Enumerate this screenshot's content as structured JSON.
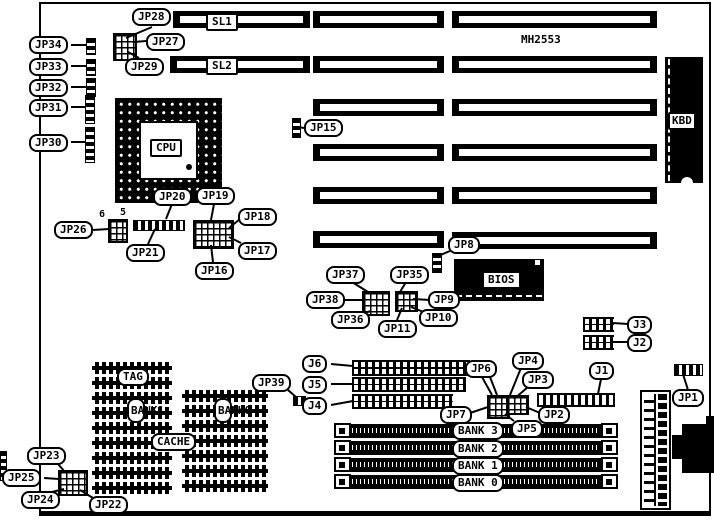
{
  "diagram": {
    "type": "motherboard jumper/connector location diagram",
    "board_model": "MH2553"
  },
  "callouts": {
    "jp28": "JP28",
    "jp27": "JP27",
    "jp29": "JP29",
    "sl1": "SL1",
    "sl2": "SL2",
    "jp34": "JP34",
    "jp33": "JP33",
    "jp32": "JP32",
    "jp31": "JP31",
    "jp30": "JP30",
    "jp15": "JP15",
    "kbd": "KBD",
    "cpu": "CPU",
    "jp20": "JP20",
    "jp19": "JP19",
    "jp18": "JP18",
    "jp17": "JP17",
    "jp16": "JP16",
    "jp26": "JP26",
    "jp21": "JP21",
    "jp8": "JP8",
    "bios": "BIOS",
    "jp37": "JP37",
    "jp35": "JP35",
    "jp38": "JP38",
    "jp9": "JP9",
    "jp36": "JP36",
    "jp11": "JP11",
    "jp10": "JP10",
    "j3": "J3",
    "j2": "J2",
    "j1": "J1",
    "jp1": "JP1",
    "j6": "J6",
    "j5": "J5",
    "j4": "J4",
    "jp6": "JP6",
    "jp4": "JP4",
    "jp3": "JP3",
    "jp7": "JP7",
    "jp2": "JP2",
    "jp5": "JP5",
    "jp39": "JP39",
    "tag": "TAG",
    "cache": "CACHE",
    "bank_col_1": "BANK1",
    "bank_col_0": "BANK0",
    "jp23": "JP23",
    "jp25": "JP25",
    "jp24": "JP24",
    "jp22": "JP22"
  },
  "pin_numbers": {
    "left": "6",
    "right": "5"
  },
  "memory_banks": [
    "BANK 3",
    "BANK 2",
    "BANK 1",
    "BANK 0"
  ]
}
